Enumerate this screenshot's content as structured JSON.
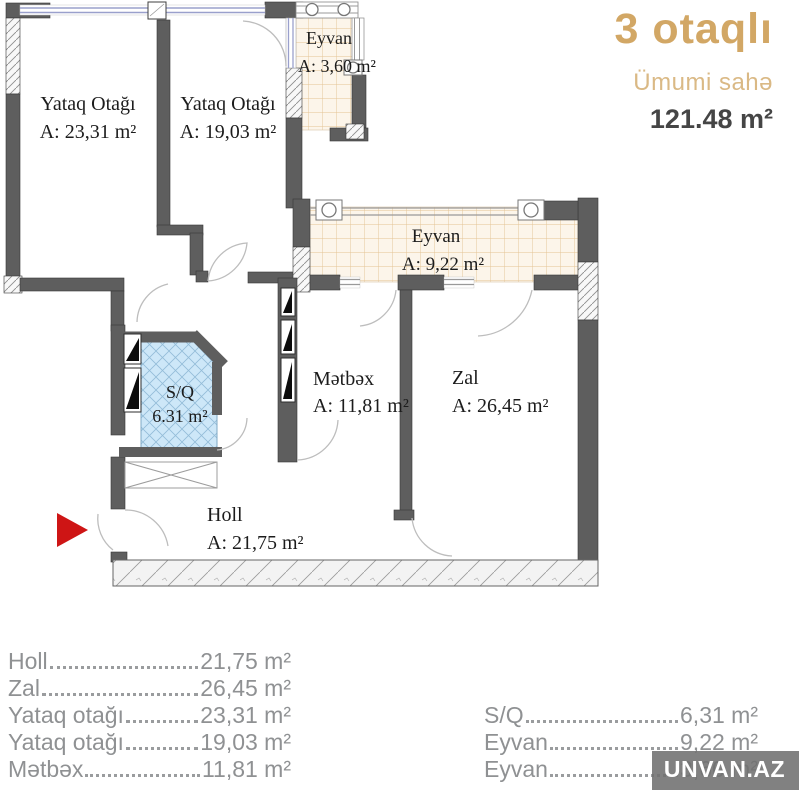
{
  "header": {
    "title": "3 otaqlı",
    "subtitle": "Ümumi sahə",
    "total_area": "121.48 m²"
  },
  "plan": {
    "rooms": {
      "bedroom1": {
        "name": "Yataq Otağı",
        "area": "A: 23,31 m²"
      },
      "bedroom2": {
        "name": "Yataq Otağı",
        "area": "A: 19,03 m²"
      },
      "eyvan_top": {
        "name": "Eyvan",
        "area": "A: 3,60 m²"
      },
      "eyvan_mid": {
        "name": "Eyvan",
        "area": "A: 9,22 m²"
      },
      "metbex": {
        "name": "Mətbəx",
        "area": "A: 11,81 m²"
      },
      "zal": {
        "name": "Zal",
        "area": "A: 26,45 m²"
      },
      "sq": {
        "name": "S/Q",
        "area": "6.31 m²"
      },
      "holl": {
        "name": "Holl",
        "area": "A: 21,75 m²"
      }
    }
  },
  "legend": {
    "left": [
      {
        "label": "Holl",
        "value": "21,75 m²"
      },
      {
        "label": "Zal",
        "value": "26,45 m²"
      },
      {
        "label": "Yataq otağı",
        "value": "23,31 m²"
      },
      {
        "label": "Yataq otağı",
        "value": "19,03 m²"
      },
      {
        "label": "Mətbəx",
        "value": "11,81 m²"
      }
    ],
    "right": [
      {
        "label": "S/Q",
        "value": "6,31 m²"
      },
      {
        "label": "Eyvan",
        "value": "9,22 m²"
      },
      {
        "label": "Eyvan",
        "value": "3,60 m²"
      }
    ]
  },
  "watermark": {
    "text": "UNVAN.AZ"
  },
  "colors": {
    "accent_gold": "#d2a765",
    "accent_gold_light": "#dab985",
    "total_text": "#454545",
    "wall": "#5e5e5e",
    "sq_tile_fill": "#cde7f8",
    "balcony_tile_line": "#e3c293",
    "legend_text": "#8f9193",
    "entry_arrow": "#ce1515"
  }
}
